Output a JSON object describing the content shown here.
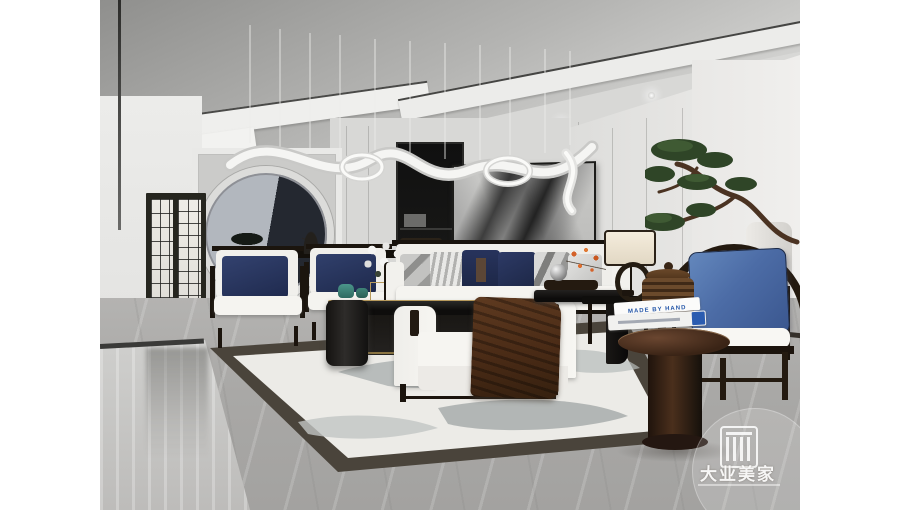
{
  "meta": {
    "type": "interior-3d-render",
    "subject": "new Chinese style living room in white, gray and navy",
    "canvas_background": "#ffffff"
  },
  "watermark": {
    "brand": "大业美家",
    "logo_name": "square-bars-monogram"
  },
  "books": {
    "top_title": "MADE BY HAND"
  },
  "palette": {
    "wall_gray": "#d8d8d6",
    "ceiling_dark": "#8f8f8d",
    "floor_marble": "#a8a7a5",
    "navy_pillow": "#27335c",
    "blue_pillow": "#4c6ca6",
    "dark_wood": "#241a10",
    "brown_throw": "#55331e",
    "teal_jar": "#3e8377",
    "gold_trim": "#b79a5c",
    "book_text_blue": "#2456a8",
    "rug_border": "#4a443b",
    "rug_field": "#ecebe7",
    "bonsai_green": "#2f4527"
  },
  "scene_objects": [
    "ribbon sculpture chandelier with hanging wires",
    "tray ceiling with recessed spotlights",
    "round moon mirror on paneled wall",
    "abstract ink wash painting",
    "black lattice glass door to hallway",
    "pair of white armchairs with navy pillows",
    "white sofa with patterned and navy pillows",
    "black gloss coffee table with teal jars",
    "white daybed bench with brown throw",
    "black waterfall side table with tray and orange flowers",
    "table lamps with cream drum shades",
    "ming style round-back chair with blue pillow",
    "round pedestal table with books and ribbed jar",
    "cascading pine bonsai",
    "ink wash area rug on gray marble floor"
  ]
}
